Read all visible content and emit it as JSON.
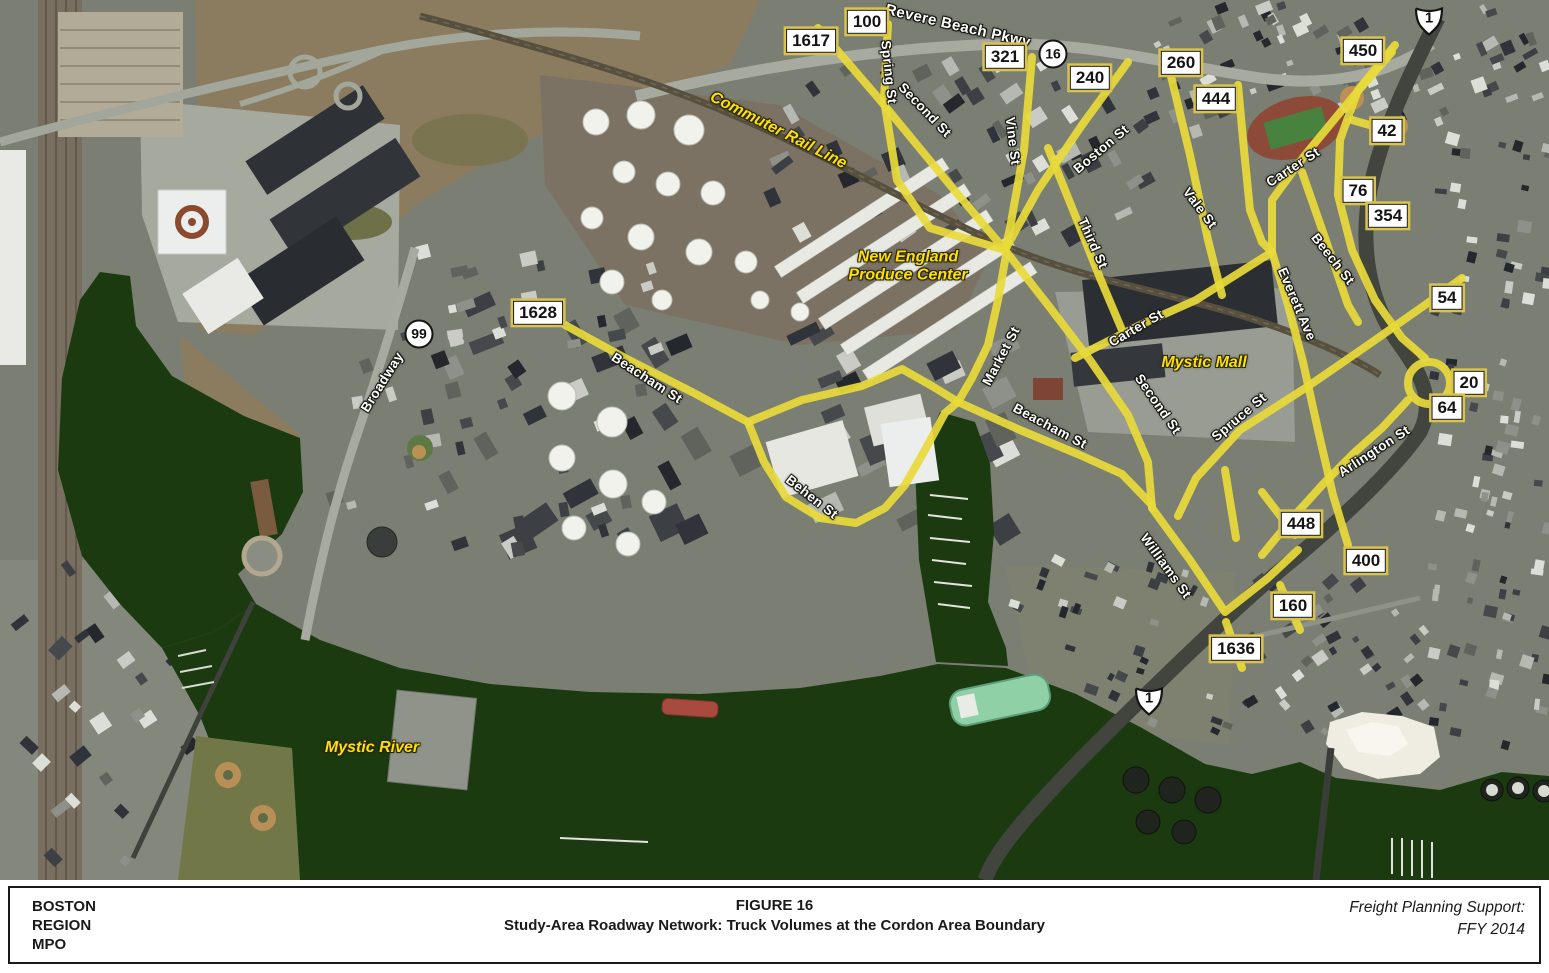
{
  "footer": {
    "org_lines": [
      "BOSTON",
      "REGION",
      "MPO"
    ],
    "figure_label": "FIGURE 16",
    "figure_title": "Study-Area Roadway Network: Truck Volumes at the Cordon Area Boundary",
    "support_lines": [
      "Freight Planning Support:",
      "FFY 2014"
    ]
  },
  "map": {
    "colors": {
      "road_highlight": "#e8da39",
      "water": "#1b3a10",
      "label_yellow": "#ffdf0a",
      "volume_box_outline": "#d9c34b",
      "land_base": "#7b7e72"
    },
    "place_labels": [
      {
        "text": "Commuter Rail Line",
        "x": 778,
        "y": 131,
        "rotate": 27
      },
      {
        "text": "New England\nProduce Center",
        "x": 908,
        "y": 267,
        "rotate": 0
      },
      {
        "text": "Mystic Mall",
        "x": 1204,
        "y": 363,
        "rotate": 0
      },
      {
        "text": "Mystic River",
        "x": 372,
        "y": 748,
        "rotate": 0
      }
    ],
    "street_labels": [
      {
        "text": "Revere Beach Pkwy",
        "x": 958,
        "y": 26,
        "rotate": 13,
        "size": 15
      },
      {
        "text": "Spring St",
        "x": 889,
        "y": 72,
        "rotate": 84
      },
      {
        "text": "Second St",
        "x": 925,
        "y": 110,
        "rotate": 46
      },
      {
        "text": "Vine St",
        "x": 1013,
        "y": 141,
        "rotate": 83
      },
      {
        "text": "Boston St",
        "x": 1101,
        "y": 149,
        "rotate": -40
      },
      {
        "text": "Third St",
        "x": 1093,
        "y": 243,
        "rotate": 66
      },
      {
        "text": "Vale St",
        "x": 1200,
        "y": 208,
        "rotate": 53
      },
      {
        "text": "Carter St",
        "x": 1293,
        "y": 167,
        "rotate": -33
      },
      {
        "text": "Beech St",
        "x": 1333,
        "y": 259,
        "rotate": 52
      },
      {
        "text": "Everett Ave",
        "x": 1297,
        "y": 304,
        "rotate": 67
      },
      {
        "text": "Carter St",
        "x": 1136,
        "y": 328,
        "rotate": -30
      },
      {
        "text": "Market St",
        "x": 1001,
        "y": 356,
        "rotate": -62
      },
      {
        "text": "Beacham St",
        "x": 1050,
        "y": 426,
        "rotate": 28
      },
      {
        "text": "Second St",
        "x": 1158,
        "y": 404,
        "rotate": 55
      },
      {
        "text": "Spruce St",
        "x": 1239,
        "y": 417,
        "rotate": -40
      },
      {
        "text": "Arlington St",
        "x": 1374,
        "y": 451,
        "rotate": -33
      },
      {
        "text": "Williams St",
        "x": 1166,
        "y": 566,
        "rotate": 54
      },
      {
        "text": "Broadway",
        "x": 382,
        "y": 382,
        "rotate": -58
      },
      {
        "text": "Beacham St",
        "x": 647,
        "y": 378,
        "rotate": 33
      },
      {
        "text": "Behen St",
        "x": 812,
        "y": 497,
        "rotate": 38
      }
    ],
    "volume_labels": [
      {
        "value": "1617",
        "x": 811,
        "y": 41
      },
      {
        "value": "100",
        "x": 867,
        "y": 22
      },
      {
        "value": "321",
        "x": 1005,
        "y": 57
      },
      {
        "value": "240",
        "x": 1090,
        "y": 78
      },
      {
        "value": "260",
        "x": 1181,
        "y": 63
      },
      {
        "value": "444",
        "x": 1216,
        "y": 99
      },
      {
        "value": "450",
        "x": 1363,
        "y": 51
      },
      {
        "value": "42",
        "x": 1387,
        "y": 131
      },
      {
        "value": "76",
        "x": 1358,
        "y": 191
      },
      {
        "value": "354",
        "x": 1388,
        "y": 216
      },
      {
        "value": "54",
        "x": 1447,
        "y": 298
      },
      {
        "value": "20",
        "x": 1469,
        "y": 383
      },
      {
        "value": "64",
        "x": 1447,
        "y": 408
      },
      {
        "value": "448",
        "x": 1301,
        "y": 524
      },
      {
        "value": "400",
        "x": 1366,
        "y": 561
      },
      {
        "value": "160",
        "x": 1293,
        "y": 606
      },
      {
        "value": "1636",
        "x": 1236,
        "y": 649
      },
      {
        "value": "1628",
        "x": 538,
        "y": 313
      }
    ],
    "route_shields": [
      {
        "type": "circle",
        "number": "16",
        "x": 1053,
        "y": 54
      },
      {
        "type": "circle",
        "number": "99",
        "x": 419,
        "y": 334
      },
      {
        "type": "us",
        "number": "1",
        "x": 1429,
        "y": 21
      },
      {
        "type": "us",
        "number": "1",
        "x": 1149,
        "y": 701
      }
    ]
  }
}
